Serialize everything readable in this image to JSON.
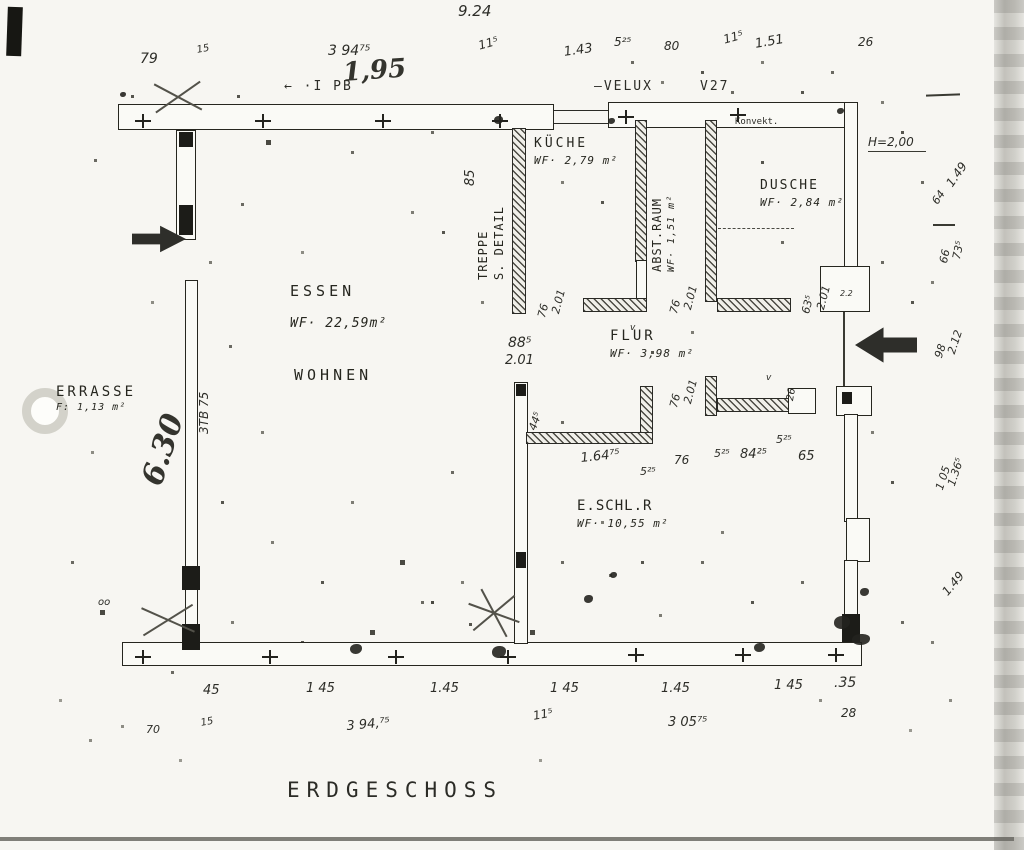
{
  "title": "ERDGESCHOSS",
  "rooms": {
    "essen": {
      "name": "ESSEN",
      "area": "WF· 22,59m²",
      "second": "WOHNEN"
    },
    "kueche": {
      "name": "KÜCHE",
      "area": "WF· 2,79 m²"
    },
    "abstraum": {
      "name": "ABST.RAUM",
      "area": "WF· 1,51 m²"
    },
    "dusche": {
      "name": "DUSCHE",
      "area": "WF· 2,84 m²"
    },
    "flur": {
      "name": "FLUR",
      "area": "WF· 3,98 m²"
    },
    "eschlr": {
      "name": "E.SCHL.R",
      "area": "WF· 10,55 m²"
    },
    "terrasse": {
      "name": "ERRASSE",
      "area": "F: 1,13 m²"
    },
    "treppe": {
      "line1": "TREPPE",
      "line2": "S. DETAIL"
    }
  },
  "ink_color": "#2b2b27",
  "annotations": [
    {
      "t": "9.24",
      "x": 458,
      "y": 4,
      "s": 15,
      "c": "hand"
    },
    {
      "t": "79",
      "x": 140,
      "y": 52,
      "s": 14,
      "c": "hand"
    },
    {
      "t": "15",
      "x": 196,
      "y": 46,
      "s": 10,
      "c": "hand",
      "r": -10
    },
    {
      "t": "3 94⁷⁵",
      "x": 328,
      "y": 44,
      "s": 14,
      "c": "hand"
    },
    {
      "t": "11⁵",
      "x": 477,
      "y": 40,
      "s": 12,
      "c": "hand",
      "r": -15
    },
    {
      "t": "1.43",
      "x": 563,
      "y": 46,
      "s": 13,
      "c": "hand",
      "r": -8
    },
    {
      "t": "5²⁵",
      "x": 614,
      "y": 36,
      "s": 12,
      "c": "hand"
    },
    {
      "t": "80",
      "x": 664,
      "y": 40,
      "s": 12,
      "c": "hand"
    },
    {
      "t": "11⁵",
      "x": 722,
      "y": 34,
      "s": 12,
      "c": "hand",
      "r": -15
    },
    {
      "t": "1.51",
      "x": 754,
      "y": 38,
      "s": 13,
      "c": "hand",
      "r": -10
    },
    {
      "t": "26",
      "x": 858,
      "y": 36,
      "s": 12,
      "c": "hand"
    },
    {
      "t": "← ·I PB",
      "x": 284,
      "y": 80,
      "s": 13,
      "c": "plan"
    },
    {
      "t": "1,95",
      "x": 342,
      "y": 60,
      "s": 26,
      "c": "script",
      "r": -4
    },
    {
      "t": "—VELUX",
      "x": 594,
      "y": 80,
      "s": 13,
      "c": "plan"
    },
    {
      "t": "V27",
      "x": 700,
      "y": 80,
      "s": 13,
      "c": "plan"
    },
    {
      "t": "Konvekt.",
      "x": 735,
      "y": 118,
      "s": 9,
      "c": "plan",
      "ls": 0
    },
    {
      "t": "H=2,00",
      "x": 868,
      "y": 136,
      "s": 12,
      "c": "hand"
    },
    {
      "t": "1.49",
      "x": 944,
      "y": 182,
      "s": 12,
      "c": "hand",
      "r": -55
    },
    {
      "t": "64",
      "x": 930,
      "y": 200,
      "s": 11,
      "c": "hand",
      "r": -55
    },
    {
      "t": "66",
      "x": 938,
      "y": 262,
      "s": 11,
      "c": "hand",
      "r": -78
    },
    {
      "t": "73⁵",
      "x": 951,
      "y": 258,
      "s": 11,
      "c": "hand",
      "r": -78
    },
    {
      "t": "98",
      "x": 933,
      "y": 356,
      "s": 11,
      "c": "hand",
      "r": -72
    },
    {
      "t": "2.12",
      "x": 946,
      "y": 352,
      "s": 11,
      "c": "hand",
      "r": -72
    },
    {
      "t": "1 05",
      "x": 934,
      "y": 488,
      "s": 11,
      "c": "hand",
      "r": -72
    },
    {
      "t": "1.36⁵",
      "x": 946,
      "y": 484,
      "s": 11,
      "c": "hand",
      "r": -72
    },
    {
      "t": "1.49",
      "x": 940,
      "y": 590,
      "s": 12,
      "c": "hand",
      "r": -50
    },
    {
      "t": "85",
      "x": 464,
      "y": 186,
      "s": 13,
      "c": "hand",
      "r": -90
    },
    {
      "t": "76",
      "x": 536,
      "y": 316,
      "s": 11,
      "c": "hand",
      "r": -75
    },
    {
      "t": "2.01",
      "x": 550,
      "y": 312,
      "s": 11,
      "c": "hand",
      "r": -75
    },
    {
      "t": "88⁵",
      "x": 508,
      "y": 336,
      "s": 14,
      "c": "hand"
    },
    {
      "t": "2.01",
      "x": 505,
      "y": 354,
      "s": 13,
      "c": "hand"
    },
    {
      "t": "76",
      "x": 668,
      "y": 312,
      "s": 11,
      "c": "hand",
      "r": -75
    },
    {
      "t": "2.01",
      "x": 682,
      "y": 308,
      "s": 11,
      "c": "hand",
      "r": -75
    },
    {
      "t": "63⁵",
      "x": 800,
      "y": 312,
      "s": 11,
      "c": "hand",
      "r": -75
    },
    {
      "t": "2.01",
      "x": 815,
      "y": 308,
      "s": 11,
      "c": "hand",
      "r": -75
    },
    {
      "t": "76",
      "x": 668,
      "y": 406,
      "s": 11,
      "c": "hand",
      "r": -75
    },
    {
      "t": "2.01",
      "x": 682,
      "y": 402,
      "s": 11,
      "c": "hand",
      "r": -75
    },
    {
      "t": "26",
      "x": 786,
      "y": 400,
      "s": 10,
      "c": "hand",
      "r": -80
    },
    {
      "t": "44⁵",
      "x": 527,
      "y": 428,
      "s": 11,
      "c": "hand",
      "r": -70
    },
    {
      "t": "2.2",
      "x": 840,
      "y": 290,
      "s": 8,
      "c": "hand"
    },
    {
      "t": "v",
      "x": 630,
      "y": 324,
      "s": 9,
      "c": "hand"
    },
    {
      "t": "v",
      "x": 766,
      "y": 374,
      "s": 9,
      "c": "hand"
    },
    {
      "t": "1.64⁷⁵",
      "x": 580,
      "y": 452,
      "s": 13,
      "c": "hand",
      "r": -6
    },
    {
      "t": "5²⁵",
      "x": 640,
      "y": 466,
      "s": 11,
      "c": "hand"
    },
    {
      "t": "76",
      "x": 674,
      "y": 454,
      "s": 12,
      "c": "hand"
    },
    {
      "t": "5²⁵",
      "x": 714,
      "y": 448,
      "s": 11,
      "c": "hand"
    },
    {
      "t": "84²⁵",
      "x": 740,
      "y": 448,
      "s": 13,
      "c": "hand"
    },
    {
      "t": "5²⁵",
      "x": 776,
      "y": 434,
      "s": 11,
      "c": "hand"
    },
    {
      "t": "65",
      "x": 798,
      "y": 450,
      "s": 13,
      "c": "hand"
    },
    {
      "t": "6.30",
      "x": 138,
      "y": 480,
      "s": 30,
      "c": "script",
      "r": -72
    },
    {
      "t": "3TB 75",
      "x": 198,
      "y": 434,
      "s": 12,
      "c": "hand",
      "r": -90
    },
    {
      "t": "oo",
      "x": 98,
      "y": 598,
      "s": 10,
      "c": "hand"
    },
    {
      "t": "45",
      "x": 203,
      "y": 684,
      "s": 13,
      "c": "hand"
    },
    {
      "t": "1 45",
      "x": 306,
      "y": 682,
      "s": 13,
      "c": "hand"
    },
    {
      "t": "1.45",
      "x": 430,
      "y": 682,
      "s": 13,
      "c": "hand"
    },
    {
      "t": "1 45",
      "x": 550,
      "y": 682,
      "s": 13,
      "c": "hand"
    },
    {
      "t": "1.45",
      "x": 661,
      "y": 682,
      "s": 13,
      "c": "hand"
    },
    {
      "t": "1 45",
      "x": 774,
      "y": 679,
      "s": 13,
      "c": "hand"
    },
    {
      "t": ".35",
      "x": 834,
      "y": 676,
      "s": 14,
      "c": "hand"
    },
    {
      "t": "70",
      "x": 146,
      "y": 724,
      "s": 11,
      "c": "hand"
    },
    {
      "t": "15",
      "x": 200,
      "y": 719,
      "s": 10,
      "c": "hand",
      "r": -10
    },
    {
      "t": "3 94,⁷⁵",
      "x": 346,
      "y": 720,
      "s": 13,
      "c": "hand",
      "r": -5
    },
    {
      "t": "11⁵",
      "x": 532,
      "y": 710,
      "s": 12,
      "c": "hand",
      "r": -10
    },
    {
      "t": "3 05⁷⁵",
      "x": 668,
      "y": 716,
      "s": 13,
      "c": "hand"
    },
    {
      "t": "28",
      "x": 841,
      "y": 707,
      "s": 12,
      "c": "hand"
    }
  ],
  "cross_marks": [
    [
      135,
      114
    ],
    [
      255,
      114
    ],
    [
      375,
      114
    ],
    [
      492,
      114
    ],
    [
      618,
      110
    ],
    [
      730,
      108
    ],
    [
      135,
      650
    ],
    [
      262,
      650
    ],
    [
      388,
      650
    ],
    [
      500,
      650
    ],
    [
      628,
      648
    ],
    [
      735,
      648
    ],
    [
      828,
      648
    ]
  ]
}
